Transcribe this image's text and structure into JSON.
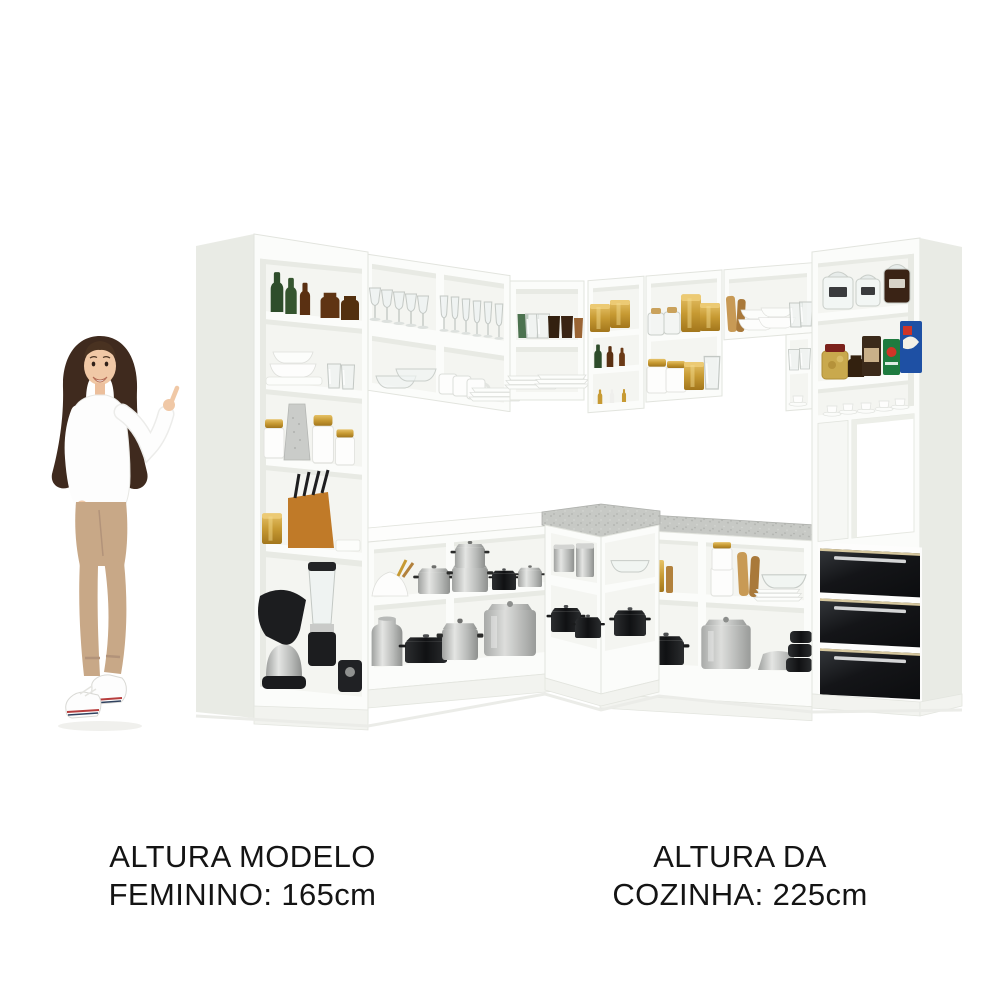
{
  "page": {
    "background": "#ffffff",
    "width": 1000,
    "height": 1000
  },
  "captions": {
    "model_height": {
      "line1": "ALTURA MODELO",
      "line2": "FEMININO: 165cm"
    },
    "kitchen_height": {
      "line1": "ALTURA DA",
      "line2": "COZINHA: 225cm"
    }
  },
  "scene": {
    "type": "product-photo",
    "subject": "Complete L-shaped corner kitchen set, white cabinets with open shelving, gray stone countertops and a three-drawer black gloss unit",
    "model_pose": "Female model with long dark hair, white sweater, beige cropped trousers and white sneakers, pointing at the kitchen",
    "palette": {
      "background": "#ffffff",
      "cabinet-front": "#fbfcfa",
      "cabinet-interior": "#f4f5f1",
      "cabinet-side": "#e9ebe5",
      "cabinet-shadow": "#e2e4de",
      "countertop-granite": "#c7c9c5",
      "drawers-black": "#141518",
      "gold-accent": "#c79a33",
      "text": "#141414"
    },
    "kitchen_items": {
      "left_tall_cabinet": [
        "green glass bottles",
        "brown glass bottles",
        "brown jars",
        "white dinnerware stack",
        "drinking glasses",
        "white canisters with gold lids",
        "metal grater",
        "knife block with knives",
        "gold canister",
        "stand mixer",
        "blender",
        "black kitchen scale"
      ],
      "upper_shelves": [
        "wine glasses",
        "champagne flutes",
        "glass bowls",
        "white mugs",
        "white plates",
        "colored tumblers",
        "gold canisters",
        "green and amber bottles",
        "salt and pepper shakers",
        "glass jars with cork lids",
        "white jars with gold lids",
        "glass pitcher",
        "stacked white bowls",
        "cutting boards"
      ],
      "base_cabinets": [
        "white mixing bowl",
        "wooden utensils",
        "stainless pots and pans",
        "black cookware",
        "milk can",
        "aluminum stockpot",
        "gold box",
        "white canister set",
        "glass bowl",
        "stainless bowl",
        "stacked black pots",
        "silver canisters"
      ],
      "right_tall_cabinet": [
        "glass storage jars",
        "coffee jar",
        "coffee packages",
        "blue cereal box",
        "pickle jar",
        "espresso cups and saucers",
        "appliance niche",
        "three black gloss drawers with metal handles"
      ]
    }
  }
}
